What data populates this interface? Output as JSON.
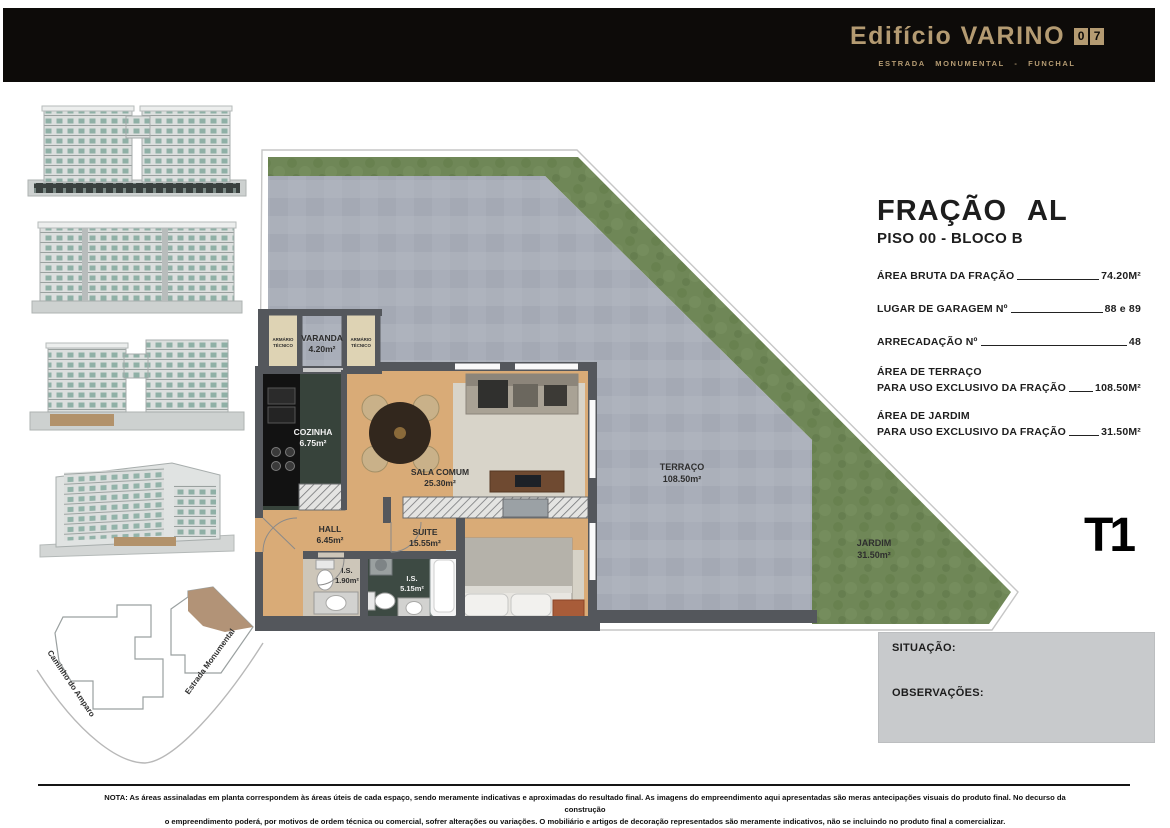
{
  "header": {
    "bg": "#0d0b09",
    "accent": "#b49b72",
    "title": "Edifício VARINO",
    "number_digits": [
      "0",
      "7"
    ],
    "subtitle": "ESTRADA MONUMENTAL - FUNCHAL"
  },
  "fraction": {
    "title": "FRAÇÃO AL",
    "floor": "PISO 00 - BLOCO B",
    "typology": "T1",
    "details": [
      {
        "label": "ÁREA BRUTA DA FRAÇÃO",
        "value": "74.20M²"
      },
      {
        "label": "LUGAR DE GARAGEM Nº",
        "value": "88 e 89"
      },
      {
        "label": "ARRECADAÇÃO Nº",
        "value": "48"
      },
      {
        "label_top": "ÁREA DE TERRAÇO",
        "label": "PARA USO EXCLUSIVO DA FRAÇÃO",
        "value": "108.50M²"
      },
      {
        "label_top": "ÁREA DE JARDIM",
        "label": "PARA USO EXCLUSIVO DA FRAÇÃO",
        "value": "31.50M²"
      }
    ]
  },
  "plan": {
    "colors": {
      "terrace": "#a9aeb9",
      "grass": "#6f8757",
      "wall": "#54575c",
      "wood": "#d9ab77",
      "kitchen_floor": "#37433b"
    },
    "varanda": {
      "name": "VARANDA",
      "area": "4.20m²"
    },
    "armario": {
      "line1": "ARMÁRIO",
      "line2": "TÉCNICO"
    },
    "cozinha": {
      "name": "COZINHA",
      "area": "6.75m²"
    },
    "sala": {
      "name": "SALA COMUM",
      "area": "25.30m²"
    },
    "hall": {
      "name": "HALL",
      "area": "6.45m²"
    },
    "suite": {
      "name": "SUITE",
      "area": "15.55m²"
    },
    "is_small": {
      "name": "I.S.",
      "area": "1.90m²"
    },
    "is_large": {
      "name": "I.S.",
      "area": "5.15m²"
    },
    "terraco": {
      "name": "TERRAÇO",
      "area": "108.50m²"
    },
    "jardim": {
      "name": "JARDIM",
      "area": "31.50m²"
    }
  },
  "site": {
    "street_left": "Caminho do Amparo",
    "street_right": "Estrada Monumental"
  },
  "info_box": {
    "situacao": "SITUAÇÃO:",
    "observacoes": "OBSERVAÇÕES:"
  },
  "note": {
    "line1": "NOTA: As áreas assinaladas em planta correspondem às áreas úteis de cada espaço, sendo meramente indicativas e aproximadas do resultado final.  As imagens do empreendimento aqui apresentadas são meras antecipações visuais do produto final. No decurso da construção",
    "line2": "o empreendimento poderá, por motivos de ordem técnica ou comercial, sofrer alterações ou variações. O mobiliário e artigos de decoração representados são meramente indicativos, não se incluindo no produto final a comercializar."
  }
}
